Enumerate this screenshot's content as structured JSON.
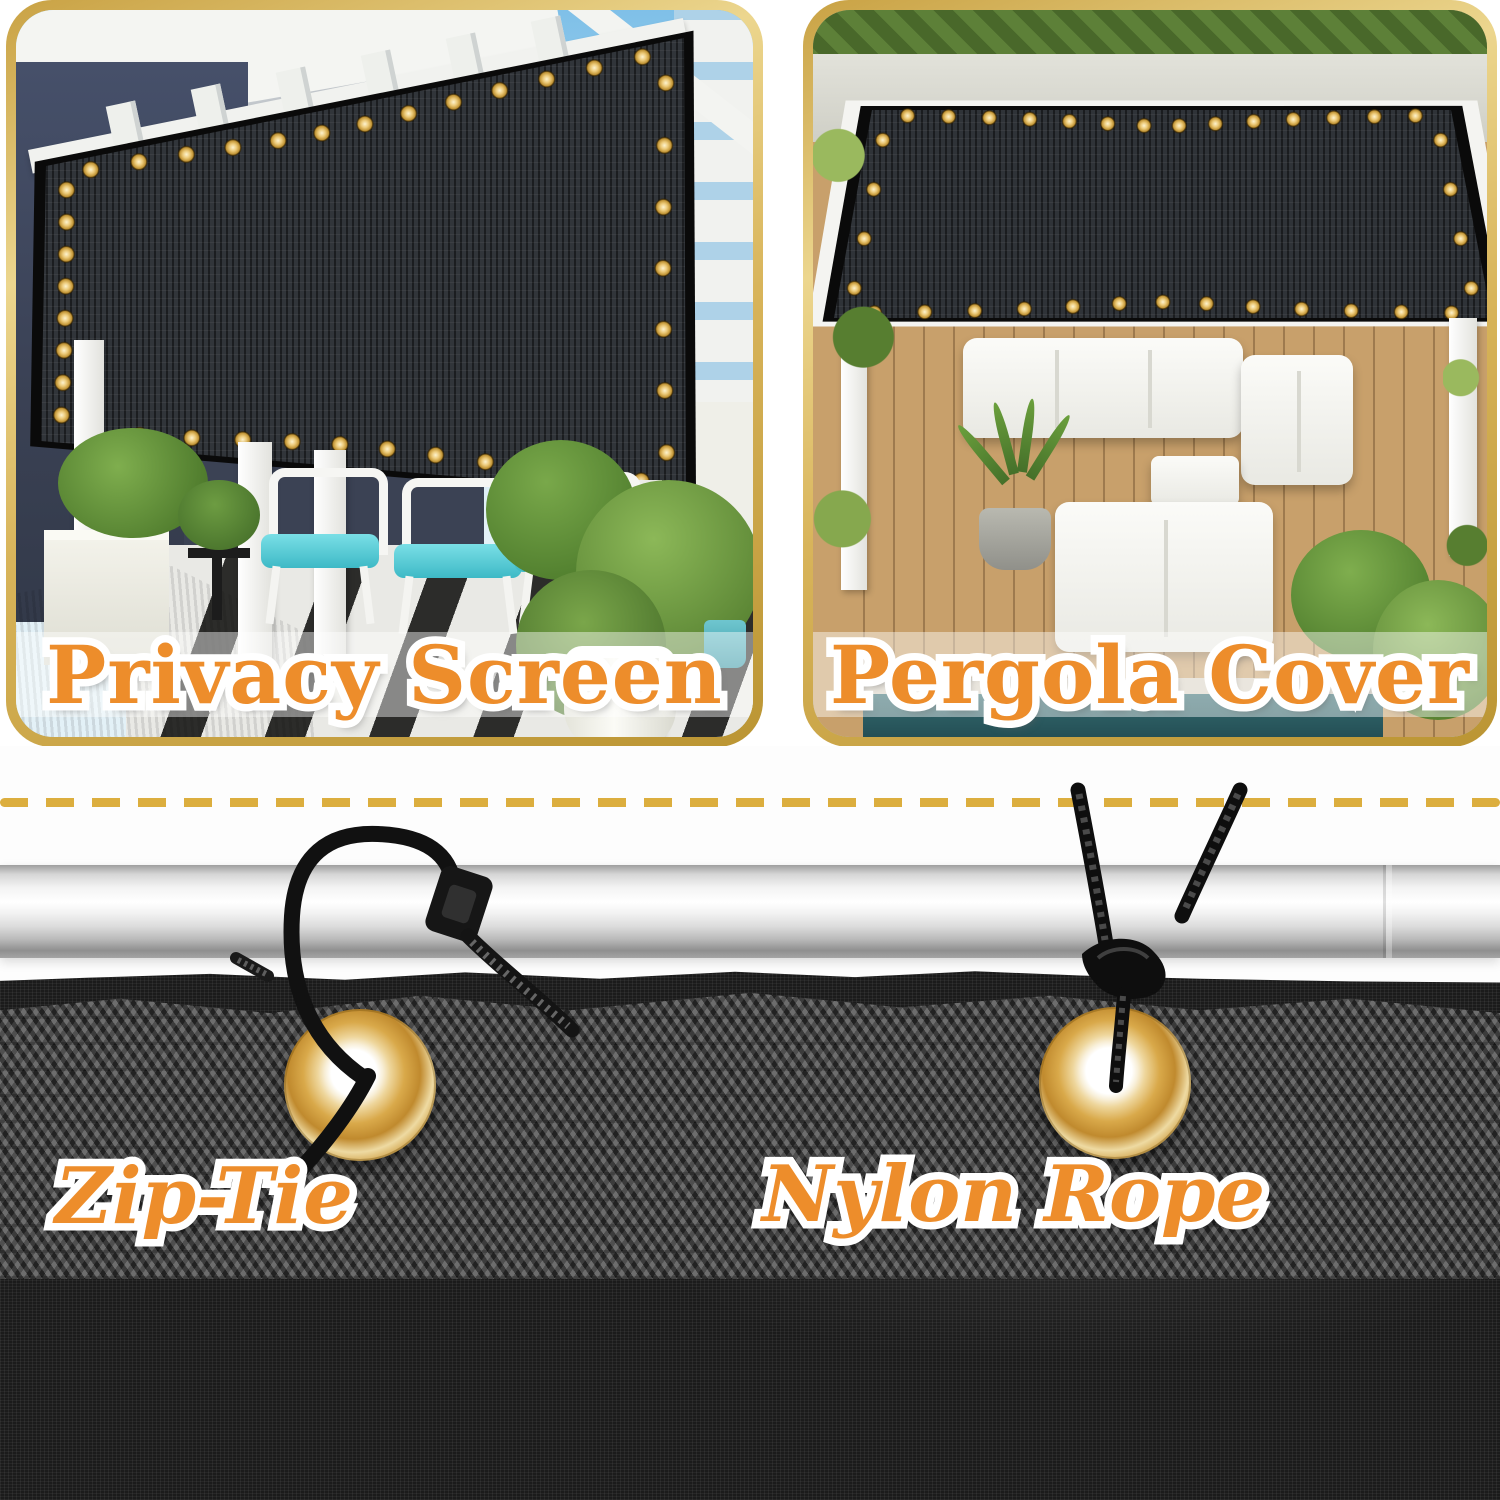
{
  "panels": [
    {
      "id": "privacy-screen",
      "caption": "Privacy Screen"
    },
    {
      "id": "pergola-cover",
      "caption": "Pergola Cover"
    }
  ],
  "bottom": {
    "labels": [
      {
        "caption": "Zip-Tie"
      },
      {
        "caption": "Nylon Rope"
      }
    ]
  },
  "colors": {
    "accent_orange": "#ED8D2B",
    "caption_outline": "#FFFFFF",
    "panel_border_gold": "#D8B45A",
    "dashed_line_gold": "#DCAE3E",
    "grommet_brass": "#D9A94A",
    "mesh_black": "#1B1B1B",
    "fabric_gray": "#3F3F3F",
    "pole_silver": "#E8E8E8"
  }
}
